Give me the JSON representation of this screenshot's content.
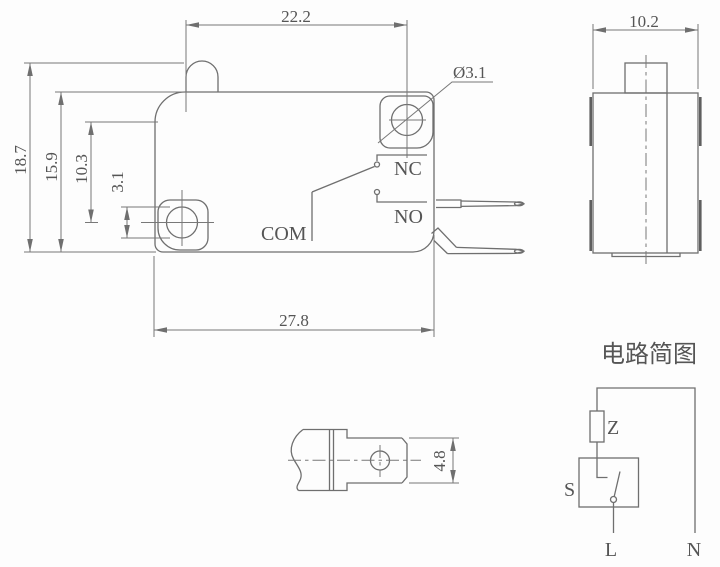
{
  "drawing": {
    "front": {
      "dim_width_top": "22.2",
      "dim_height_overall": "18.7",
      "dim_height_body": "15.9",
      "dim_hole_offset": "10.3",
      "dim_hole_diameter": "3.1",
      "dim_width_bottom": "27.8",
      "hole_callout": "Ø3.1",
      "label_nc": "NC",
      "label_no": "NO",
      "label_com": "COM"
    },
    "side": {
      "dim_width": "10.2"
    },
    "terminal_detail": {
      "dim_width": "4.8"
    },
    "circuit": {
      "title": "电路简图",
      "label_impedance": "Z",
      "label_switch": "S",
      "label_live": "L",
      "label_neutral": "N"
    },
    "colors": {
      "line": "#6f6f6f",
      "text": "#555555",
      "background": "#fdfdfd"
    }
  }
}
